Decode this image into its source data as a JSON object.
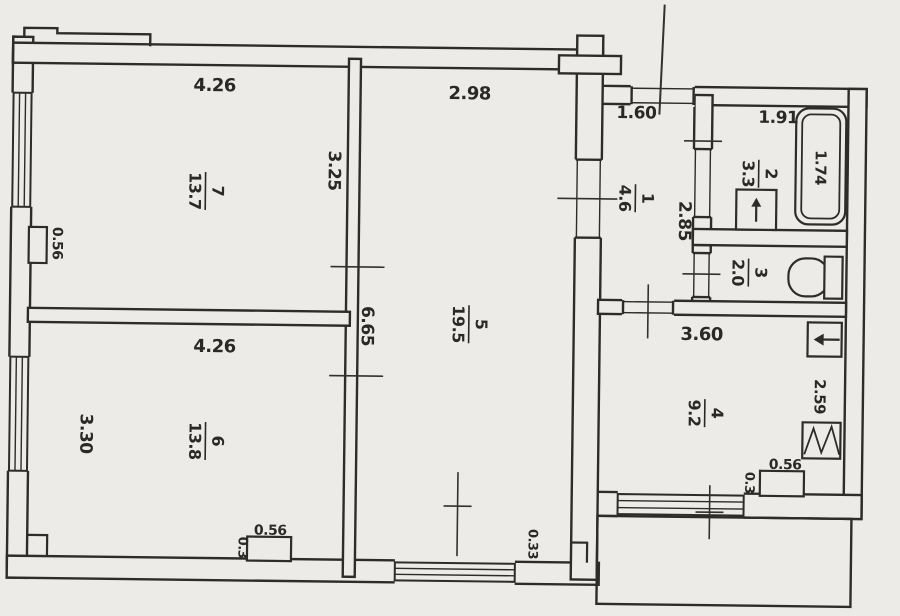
{
  "plan": {
    "rooms": [
      {
        "number": "1",
        "area": "4.6"
      },
      {
        "number": "2",
        "area": "3.3"
      },
      {
        "number": "3",
        "area": "2.0"
      },
      {
        "number": "4",
        "area": "9.2"
      },
      {
        "number": "5",
        "area": "19.5"
      },
      {
        "number": "6",
        "area": "13.8"
      },
      {
        "number": "7",
        "area": "13.7"
      }
    ],
    "dimensions": {
      "room7_width": "4.26",
      "room7_depth": "3.25",
      "room7_niche": "0.56",
      "room5_width": "2.98",
      "room5_depth": "6.65",
      "room5_offset": "0.33",
      "room6_width": "4.26",
      "room6_depth": "3.30",
      "room6_ledge_width": "0.56",
      "room6_ledge_depth": "0.3",
      "hall_width": "1.60",
      "hall_depth": "2.85",
      "bath_width": "1.91",
      "bathtub_length": "1.74",
      "kitchen_width": "3.60",
      "kitchen_depth": "2.59",
      "kitchen_ledge_width": "0.56",
      "kitchen_ledge_depth": "0.3"
    },
    "colors": {
      "ink": "#2e2c28",
      "paper": "#ecebe7"
    }
  }
}
